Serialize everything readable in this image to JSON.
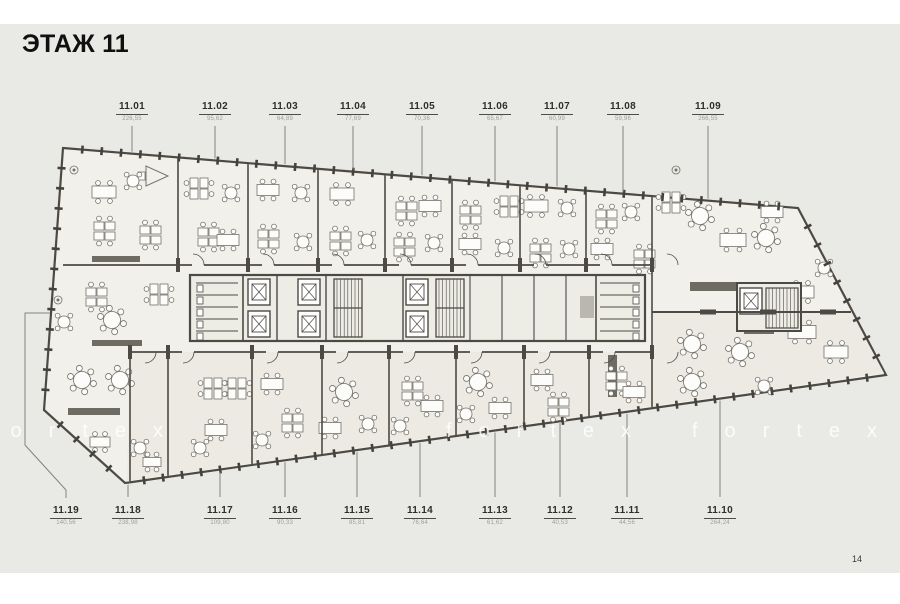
{
  "page": {
    "title": "ЭТАЖ 11",
    "page_number": "14",
    "watermark": "fortex",
    "colors": {
      "background": "#e9e9e6",
      "building_fill": "#f1f0ea",
      "lower_band_fill": "#eceae2",
      "core_fill": "#edece5",
      "wall": "#4d4a44",
      "tick": "#44423c",
      "furniture_stroke": "#75726a",
      "furniture_fill": "#fcfcfa",
      "counter_fill": "#6e6b63",
      "leader": "#84847f",
      "label_text": "#2e2e2c",
      "area_text": "#9d9d98"
    }
  },
  "units_top": [
    {
      "id": "11.01",
      "area": "226,55",
      "x": 132
    },
    {
      "id": "11.02",
      "area": "95,62",
      "x": 215
    },
    {
      "id": "11.03",
      "area": "64,89",
      "x": 285
    },
    {
      "id": "11.04",
      "area": "77,69",
      "x": 353
    },
    {
      "id": "11.05",
      "area": "70,36",
      "x": 422
    },
    {
      "id": "11.06",
      "area": "65,67",
      "x": 495
    },
    {
      "id": "11.07",
      "area": "60,99",
      "x": 557
    },
    {
      "id": "11.08",
      "area": "59,96",
      "x": 623
    },
    {
      "id": "11.09",
      "area": "266,55",
      "x": 708
    }
  ],
  "units_bottom": [
    {
      "id": "11.19",
      "area": "140,56",
      "x": 66
    },
    {
      "id": "11.18",
      "area": "238,98",
      "x": 128
    },
    {
      "id": "11.17",
      "area": "109,80",
      "x": 220
    },
    {
      "id": "11.16",
      "area": "90,33",
      "x": 285
    },
    {
      "id": "11.15",
      "area": "85,81",
      "x": 357
    },
    {
      "id": "11.14",
      "area": "76,64",
      "x": 420
    },
    {
      "id": "11.13",
      "area": "61,62",
      "x": 495
    },
    {
      "id": "11.12",
      "area": "40,53",
      "x": 560
    },
    {
      "id": "11.11",
      "area": "44,56",
      "x": 627
    },
    {
      "id": "11.10",
      "area": "264,24",
      "x": 720
    }
  ]
}
